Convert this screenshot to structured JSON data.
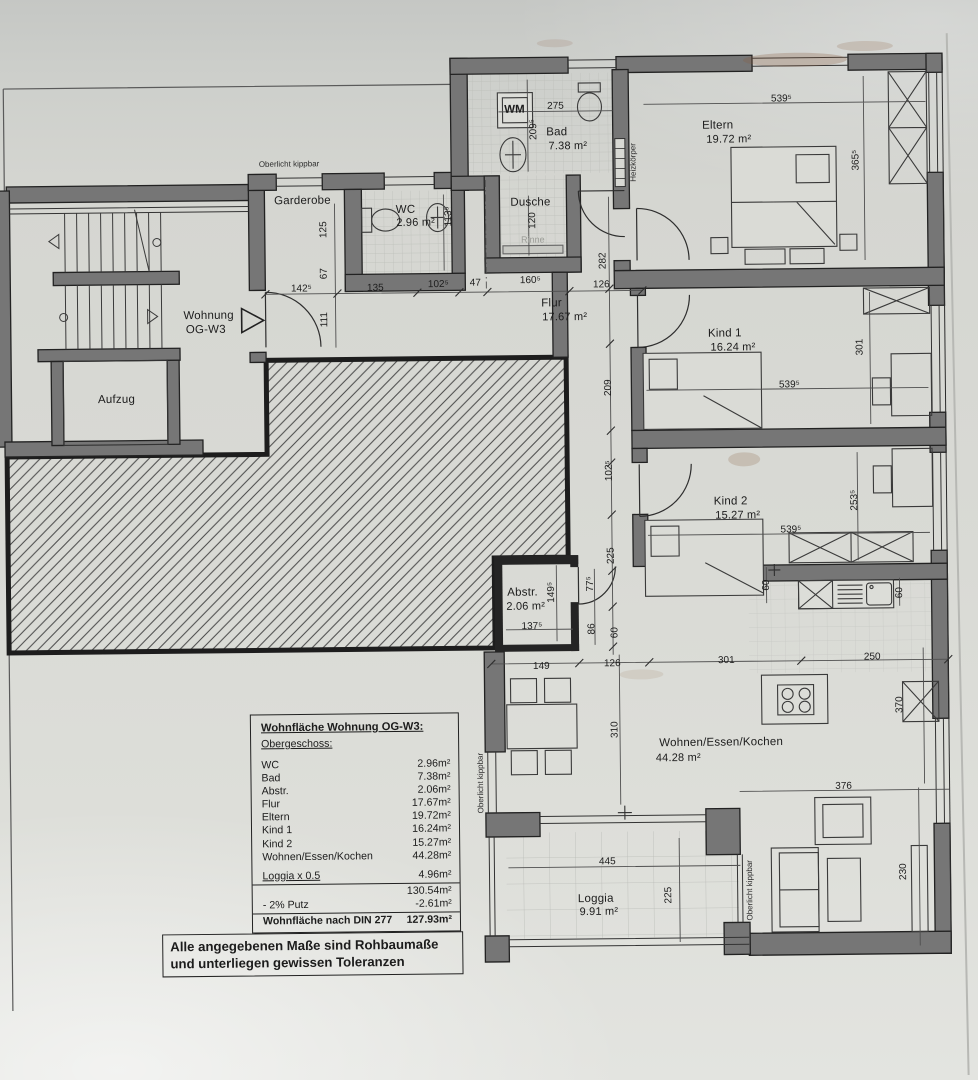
{
  "annotations": {
    "oberlicht_top": "Oberlicht kippbar",
    "oberlicht_left": "Oberlicht kippbar",
    "oberlicht_loggia": "Oberlicht kippbar",
    "heizkoerper": "Heizkörper",
    "rinne": "Rinne",
    "wm": "WM",
    "wohnung_line1": "Wohnung",
    "wohnung_line2": "OG-W3"
  },
  "rooms": {
    "garderobe": {
      "name": "Garderobe"
    },
    "wc": {
      "name": "WC",
      "area": "2.96 m²"
    },
    "bad": {
      "name": "Bad",
      "area": "7.38 m²"
    },
    "dusche": {
      "name": "Dusche"
    },
    "flur": {
      "name": "Flur",
      "area": "17.67 m²"
    },
    "eltern": {
      "name": "Eltern",
      "area": "19.72 m²"
    },
    "kind1": {
      "name": "Kind 1",
      "area": "16.24 m²"
    },
    "kind2": {
      "name": "Kind 2",
      "area": "15.27 m²"
    },
    "abstr": {
      "name": "Abstr.",
      "area": "2.06 m²"
    },
    "wohnen": {
      "name": "Wohnen/Essen/Kochen",
      "area": "44.28 m²"
    },
    "loggia": {
      "name": "Loggia",
      "area": "9.91 m²"
    },
    "aufzug": {
      "name": "Aufzug"
    }
  },
  "dims": [
    "275",
    "209⁵",
    "120",
    "113⁵",
    "125",
    "67",
    "111",
    "142⁵",
    "135",
    "102⁵",
    "47",
    "160⁵",
    "126",
    "282",
    "209",
    "102⁵",
    "225",
    "77⁵",
    "149⁵",
    "137⁵",
    "86",
    "60",
    "149",
    "126",
    "301",
    "250",
    "310",
    "60",
    "60",
    "370",
    "376",
    "445",
    "225",
    "230",
    "539⁵",
    "365⁵",
    "539⁵",
    "301",
    "539⁵",
    "253⁵"
  ],
  "table": {
    "title": "Wohnfläche Wohnung OG-W3:",
    "subtitle": "Obergeschoss:",
    "rows": [
      [
        "WC",
        "2.96m²"
      ],
      [
        "Bad",
        "7.38m²"
      ],
      [
        "Abstr.",
        "2.06m²"
      ],
      [
        "Flur",
        "17.67m²"
      ],
      [
        "Eltern",
        "19.72m²"
      ],
      [
        "Kind 1",
        "16.24m²"
      ],
      [
        "Kind 2",
        "15.27m²"
      ],
      [
        "Wohnen/Essen/Kochen",
        "44.28m²"
      ]
    ],
    "loggia_row": [
      "Loggia x 0.5",
      "4.96m²"
    ],
    "subtotal": "130.54m²",
    "putz_row": [
      "- 2% Putz",
      "-2.61m²"
    ],
    "total_row": [
      "Wohnfläche nach DIN 277",
      "127.93m²"
    ]
  },
  "note": {
    "line1": "Alle angegebenen Maße sind Rohbaumaße",
    "line2": "und unterliegen gewissen Toleranzen"
  }
}
